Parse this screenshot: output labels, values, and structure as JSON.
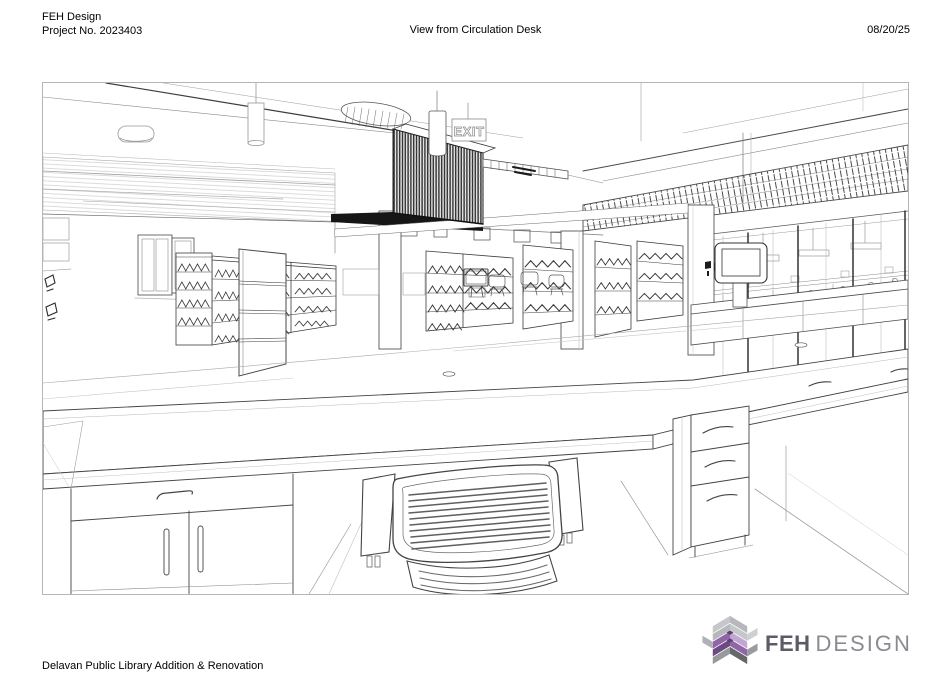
{
  "header": {
    "firm": "FEH Design",
    "project_no": "Project No. 2023403",
    "view_title": "View from Circulation Desk",
    "date": "08/20/25"
  },
  "footer": {
    "project_name": "Delavan Public Library Addition & Renovation"
  },
  "logo": {
    "primary": "FEH",
    "secondary": "DESIGN",
    "colors": {
      "text_dark": "#5b5c66",
      "text_light": "#8a8b91",
      "purple_dark": "#6d4a84",
      "purple_mid": "#9066a8",
      "purple_light": "#c0a6d1",
      "gray_light": "#c6c7c9",
      "gray_mid": "#98999c",
      "gray_dark": "#66676a"
    }
  },
  "drawing": {
    "exit_sign_label": "EXIT",
    "line_color": "#3c3c3c",
    "border_color": "#b5b5b5"
  }
}
